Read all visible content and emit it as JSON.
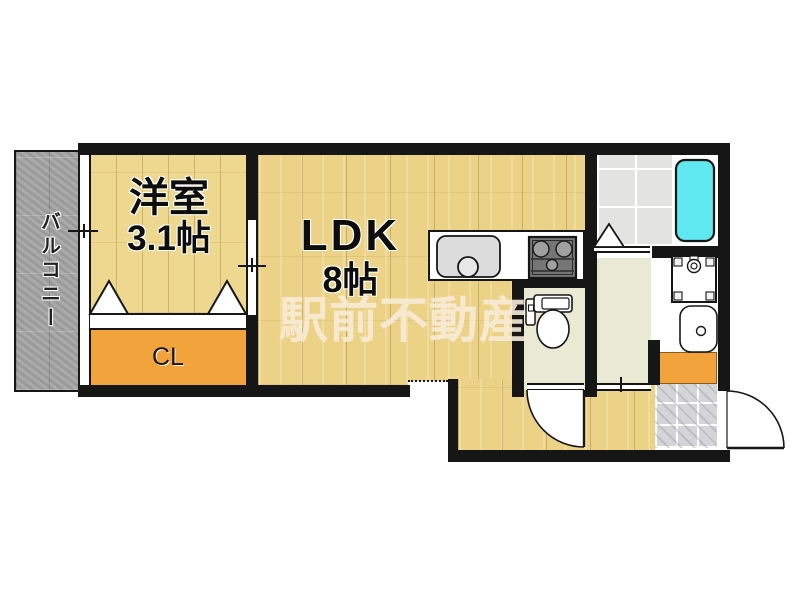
{
  "plan": {
    "watermark": "駅前不動産",
    "rooms": {
      "balcony": {
        "label": "バルコニー"
      },
      "western_room": {
        "label": "洋室",
        "size": "3.1帖"
      },
      "ldk": {
        "label": "LDK",
        "size": "8帖"
      },
      "closet": {
        "label": "CL"
      },
      "bathroom": {
        "label": ""
      },
      "washroom": {
        "label": ""
      },
      "toilet": {
        "label": ""
      },
      "entrance": {
        "label": ""
      }
    },
    "fixtures": [
      "kitchen-sink",
      "gas-stove",
      "bathtub",
      "toilet",
      "washing-machine-pan",
      "washbasin",
      "shoe-cabinet",
      "entrance-door",
      "toilet-door",
      "closet-folding-doors",
      "bath-folding-door",
      "balcony-window",
      "sliding-door"
    ],
    "colors": {
      "wall": "#161616",
      "wood_floor": "#ecd287",
      "western_floor": "#eed78e",
      "closet_orange": "#f2a33c",
      "balcony_gray": "#a4a4a4",
      "bath_tile": "#e3e3e2",
      "bathtub_cyan": "#5fe8f0",
      "service_floor": "#eae9d3",
      "entrance_marble": "#d5d5d9",
      "watermark_cream": "#f8ecd9"
    }
  }
}
